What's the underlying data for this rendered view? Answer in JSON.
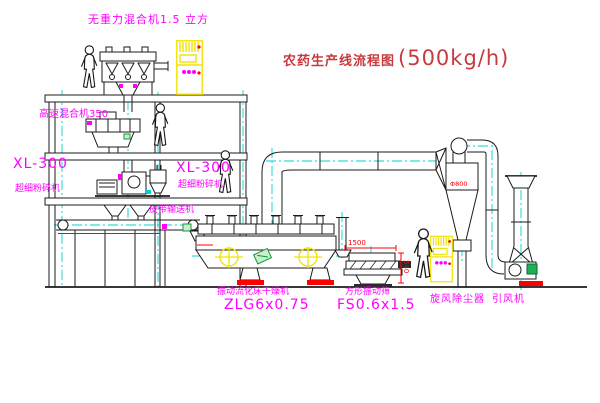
{
  "colors": {
    "line": "#1b1b1b",
    "magenta": "#ff00ff",
    "red": "#ff0000",
    "title": "#c93a3e",
    "yellow": "#f0e300",
    "cyan": "#00d2d2",
    "green": "#0a9a3c",
    "bg": "#ffffff"
  },
  "title": {
    "name": "农药生产线流程图",
    "capacity": "(500kg/h)"
  },
  "labels": {
    "gravity_mixer": "无重力混合机1.5 立方",
    "high_speed_mixer": "高速混合机350",
    "pulverizer_left_model": "XL-300",
    "pulverizer_left_name": "超细粉碎机",
    "pulverizer_mid_model": "XL-300",
    "pulverizer_mid_name": "超细粉碎机",
    "belt_conveyor": "皮带输送机",
    "dryer_name": "振动流化床干燥机",
    "dryer_model": "ZLG6x0.75",
    "screen_name": "方形振动筛",
    "screen_model": "FS0.6x1.5",
    "cyclone": "旋风除尘器",
    "fan": "引风机"
  },
  "dimensions": {
    "screen_length": "1500",
    "screen_height": "540",
    "cyclone_diameter": "Φ800"
  }
}
